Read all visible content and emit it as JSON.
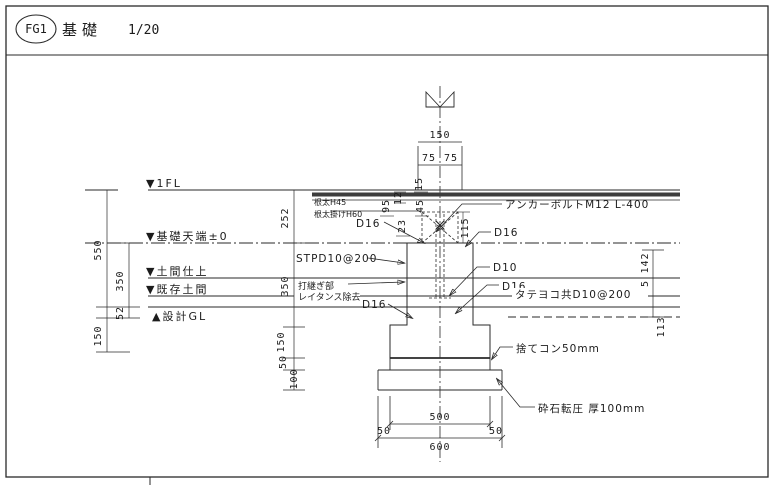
{
  "title": {
    "mark": "FG1",
    "name": "基礎",
    "scale": "1/20"
  },
  "levels": {
    "fl1": "▼1FL",
    "foundation_top": "▼基礎天端±0",
    "slab_finish": "▼土間仕上",
    "existing_slab": "▼既存土間",
    "design_gl": "▲設計GL"
  },
  "annotations": {
    "joist": "根太H45",
    "joist_hanger": "根太掛けH60",
    "anchor_bolt": "アンカーボルトM12 L-400",
    "d16_top_left": "D16",
    "d16_top_right": "D16",
    "hoop": "STPD10@200",
    "joint_line1": "打継ぎ部",
    "joint_line2": "レイタンス除去",
    "d16_mid_left": "D16",
    "d10_right": "D10",
    "d16_mid_right": "D16",
    "slab_rebar": "タテヨコ共D10@200",
    "lean_concrete": "捨てコン50mm",
    "crushed_stone": "砕石転圧 厚100mm"
  },
  "dims": {
    "top_width": "150",
    "top_half_left": "75",
    "top_half_right": "75",
    "top_15": "15",
    "floor_95": "95",
    "floor_12": "12",
    "floor_45": "45",
    "floor_23": "23",
    "sill_115": "115",
    "left_550": "550",
    "left_350": "350",
    "left_52": "52",
    "left_150": "150",
    "mid_252": "252",
    "mid_350": "350",
    "mid_150": "150",
    "mid_50": "50",
    "mid_100": "100",
    "right_142": "142",
    "right_95": "95",
    "right_113": "113",
    "bottom_500": "500",
    "bottom_50_left": "50",
    "bottom_50_right": "50",
    "bottom_600": "600"
  }
}
